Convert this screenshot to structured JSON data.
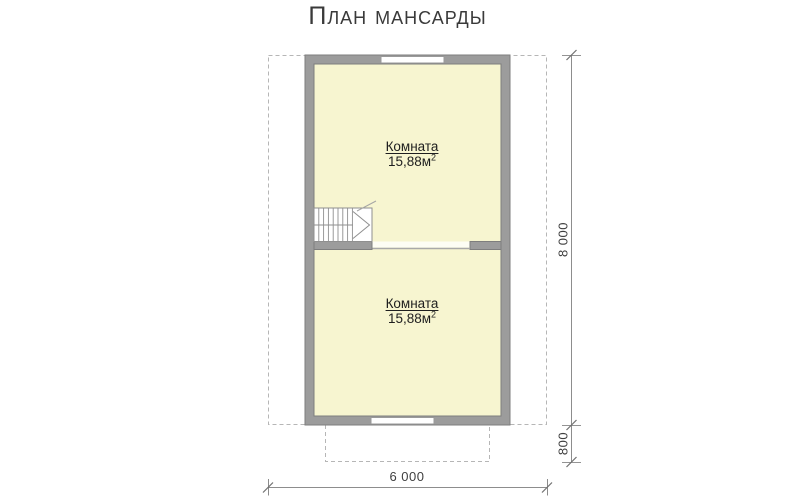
{
  "title": "План мансарды",
  "rooms": [
    {
      "label": "Комната",
      "area": "15,88м",
      "area_sup": "2"
    },
    {
      "label": "Комната",
      "area": "15,88м",
      "area_sup": "2"
    }
  ],
  "dimensions": {
    "vertical_total": "8 000",
    "vertical_porch": "800",
    "horizontal_total": "6 000"
  },
  "colors": {
    "room_fill": "#f7f5d0",
    "wall_fill": "#9c9c9c",
    "wall_edge": "#7e7e7e",
    "dashed_outline": "#b6b6b6",
    "dimension_line": "#8d8d8d",
    "label_text": "#1e1e1e",
    "dim_text": "#3f3f3f",
    "title_text": "#3a3a3a"
  }
}
